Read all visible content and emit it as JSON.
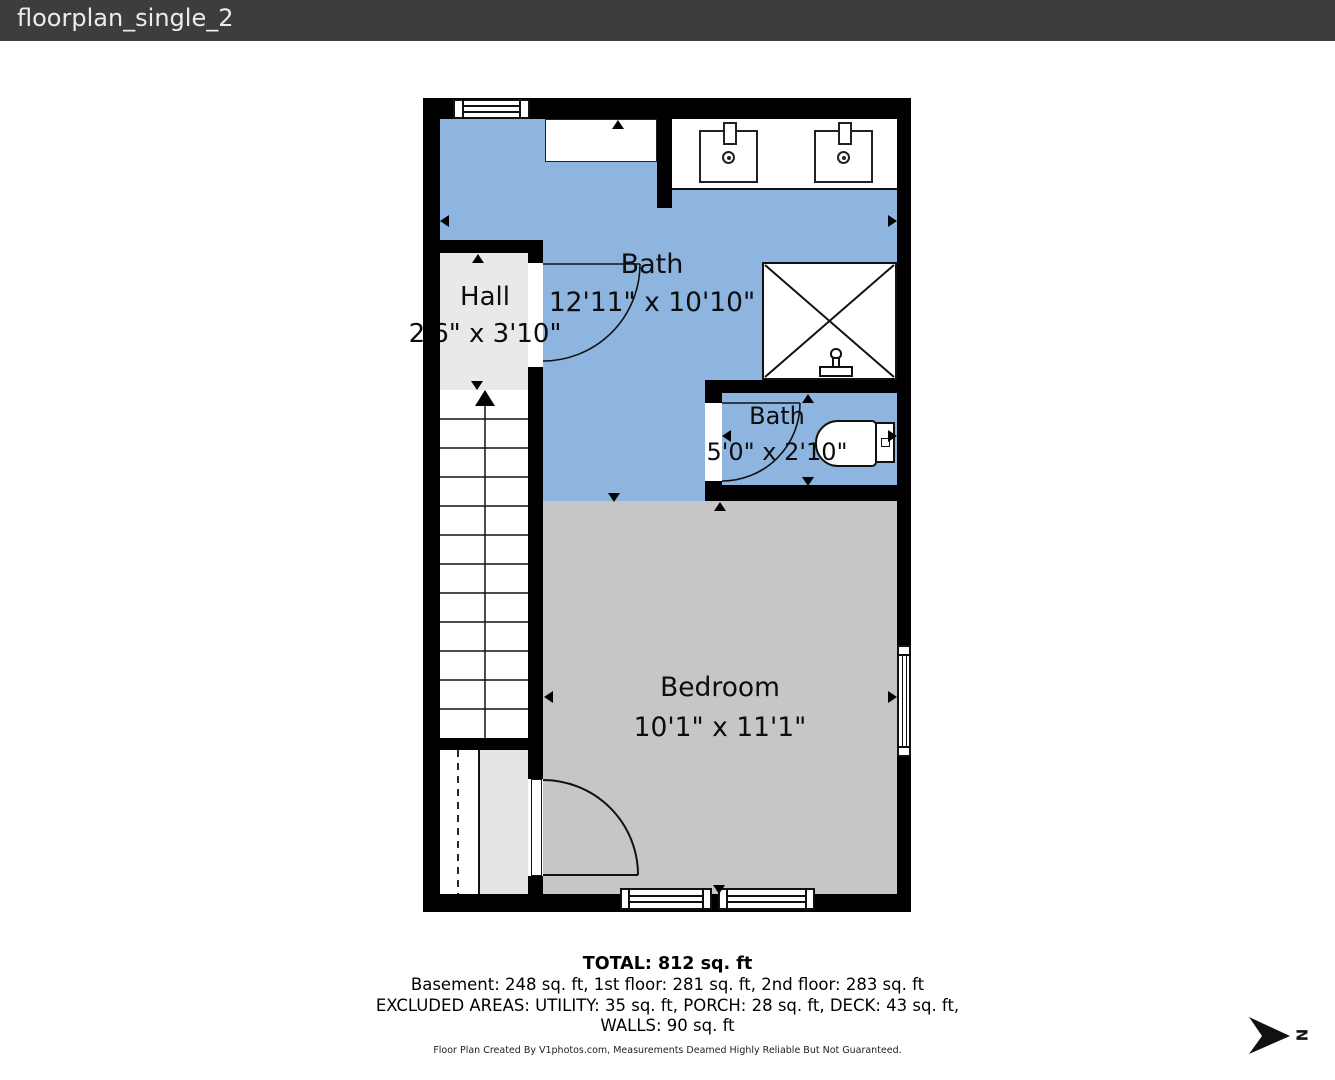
{
  "header": {
    "title": "floorplan_single_2"
  },
  "rooms": {
    "bath_main": {
      "label": "Bath",
      "dims": "12'11\" x 10'10\""
    },
    "hall": {
      "label": "Hall",
      "dims": "2'6\" x 3'10\""
    },
    "bath_small": {
      "label": "Bath",
      "dims": "5'0\" x 2'10\""
    },
    "bedroom": {
      "label": "Bedroom",
      "dims": "10'1\" x 11'1\""
    }
  },
  "summary": {
    "total": "TOTAL: 812 sq. ft",
    "floors": "Basement: 248 sq. ft, 1st floor: 281 sq. ft, 2nd floor: 283 sq. ft",
    "excluded": "EXCLUDED AREAS: UTILITY: 35 sq. ft, PORCH: 28 sq. ft, DECK: 43 sq. ft,",
    "walls": "WALLS: 90 sq. ft"
  },
  "footer": {
    "disclaimer": "Floor Plan Created By V1photos.com, Measurements Deamed Highly Reliable But Not Guaranteed."
  },
  "compass": {
    "label": "N"
  },
  "colors": {
    "header_bg": "#3d3d3d",
    "wall": "#000000",
    "bath_floor": "#8db5e0",
    "bedroom_floor": "#c6c6c6",
    "hall_floor": "#e9e9e9",
    "closet_floor": "#e4e4e4"
  }
}
